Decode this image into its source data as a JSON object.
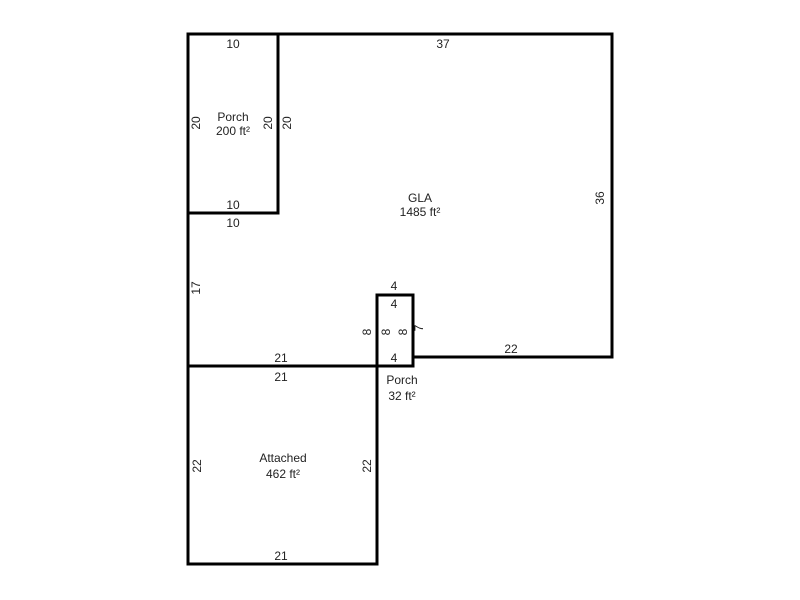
{
  "colors": {
    "background": "#ffffff",
    "wall": "#000000",
    "text": "#222222"
  },
  "rooms": {
    "porch_top": {
      "label": "Porch",
      "area": "200 ft²",
      "dims": {
        "top": "10",
        "left": "20",
        "right_inner": "20",
        "right_outer": "20",
        "bottom_inner": "10",
        "bottom_outer": "10"
      }
    },
    "gla": {
      "label": "GLA",
      "area": "1485 ft²",
      "dims": {
        "top": "37",
        "right": "36",
        "bottom_right": "22",
        "bottom_left": "21",
        "left": "17"
      }
    },
    "porch_small": {
      "label": "Porch",
      "area": "32 ft²",
      "dims": {
        "top_outer": "4",
        "top_inner": "4",
        "left_outer": "8",
        "left_inner": "8",
        "right_inner": "8",
        "right_outer": "7",
        "bottom": "4"
      }
    },
    "attached": {
      "label": "Attached",
      "area": "462 ft²",
      "dims": {
        "top": "21",
        "left": "22",
        "right": "22",
        "bottom": "21"
      }
    }
  }
}
